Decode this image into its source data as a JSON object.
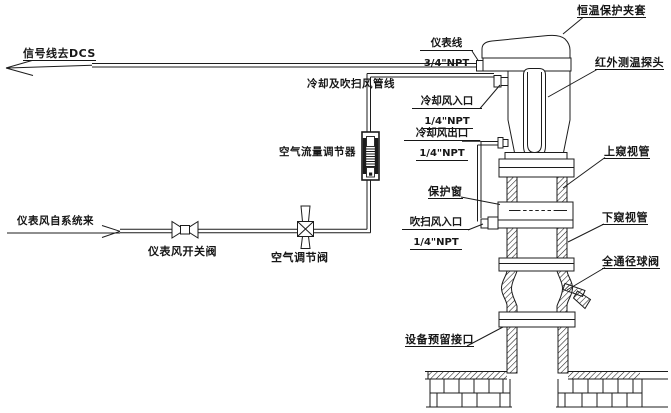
{
  "diagram": {
    "type": "piping-instrument-installation-diagram",
    "labels": {
      "signal_dcs": "信号线去DCS",
      "instrument_line": {
        "l1": "仪表线",
        "l2": "3/4\"NPT"
      },
      "cooling_purge_pipe": "冷却及吹扫风管线",
      "cooling_in": {
        "l1": "冷却风入口",
        "l2": "1/4\"NPT"
      },
      "cooling_out": {
        "l1": "冷却风出口",
        "l2": "1/4\"NPT"
      },
      "purge_in": {
        "l1": "吹扫风入口",
        "l2": "1/4\"NPT"
      },
      "air_flow_regulator": "空气流量调节器",
      "instrument_air_from": "仪表风自系统来",
      "instrument_air_valve": "仪表风开关阀",
      "air_regulating_valve": "空气调节阀",
      "protection_window": "保护窗",
      "upper_sight_tube": "上窥视管",
      "lower_sight_tube": "下窥视管",
      "full_bore_ball_valve": "全通径球阀",
      "reserved_interface": "设备预留接口",
      "thermostatic_jacket": "恒温保护夹套",
      "ir_probe": "红外测温探头"
    },
    "colors": {
      "line": "#1c1c1c",
      "background": "#ffffff"
    }
  }
}
